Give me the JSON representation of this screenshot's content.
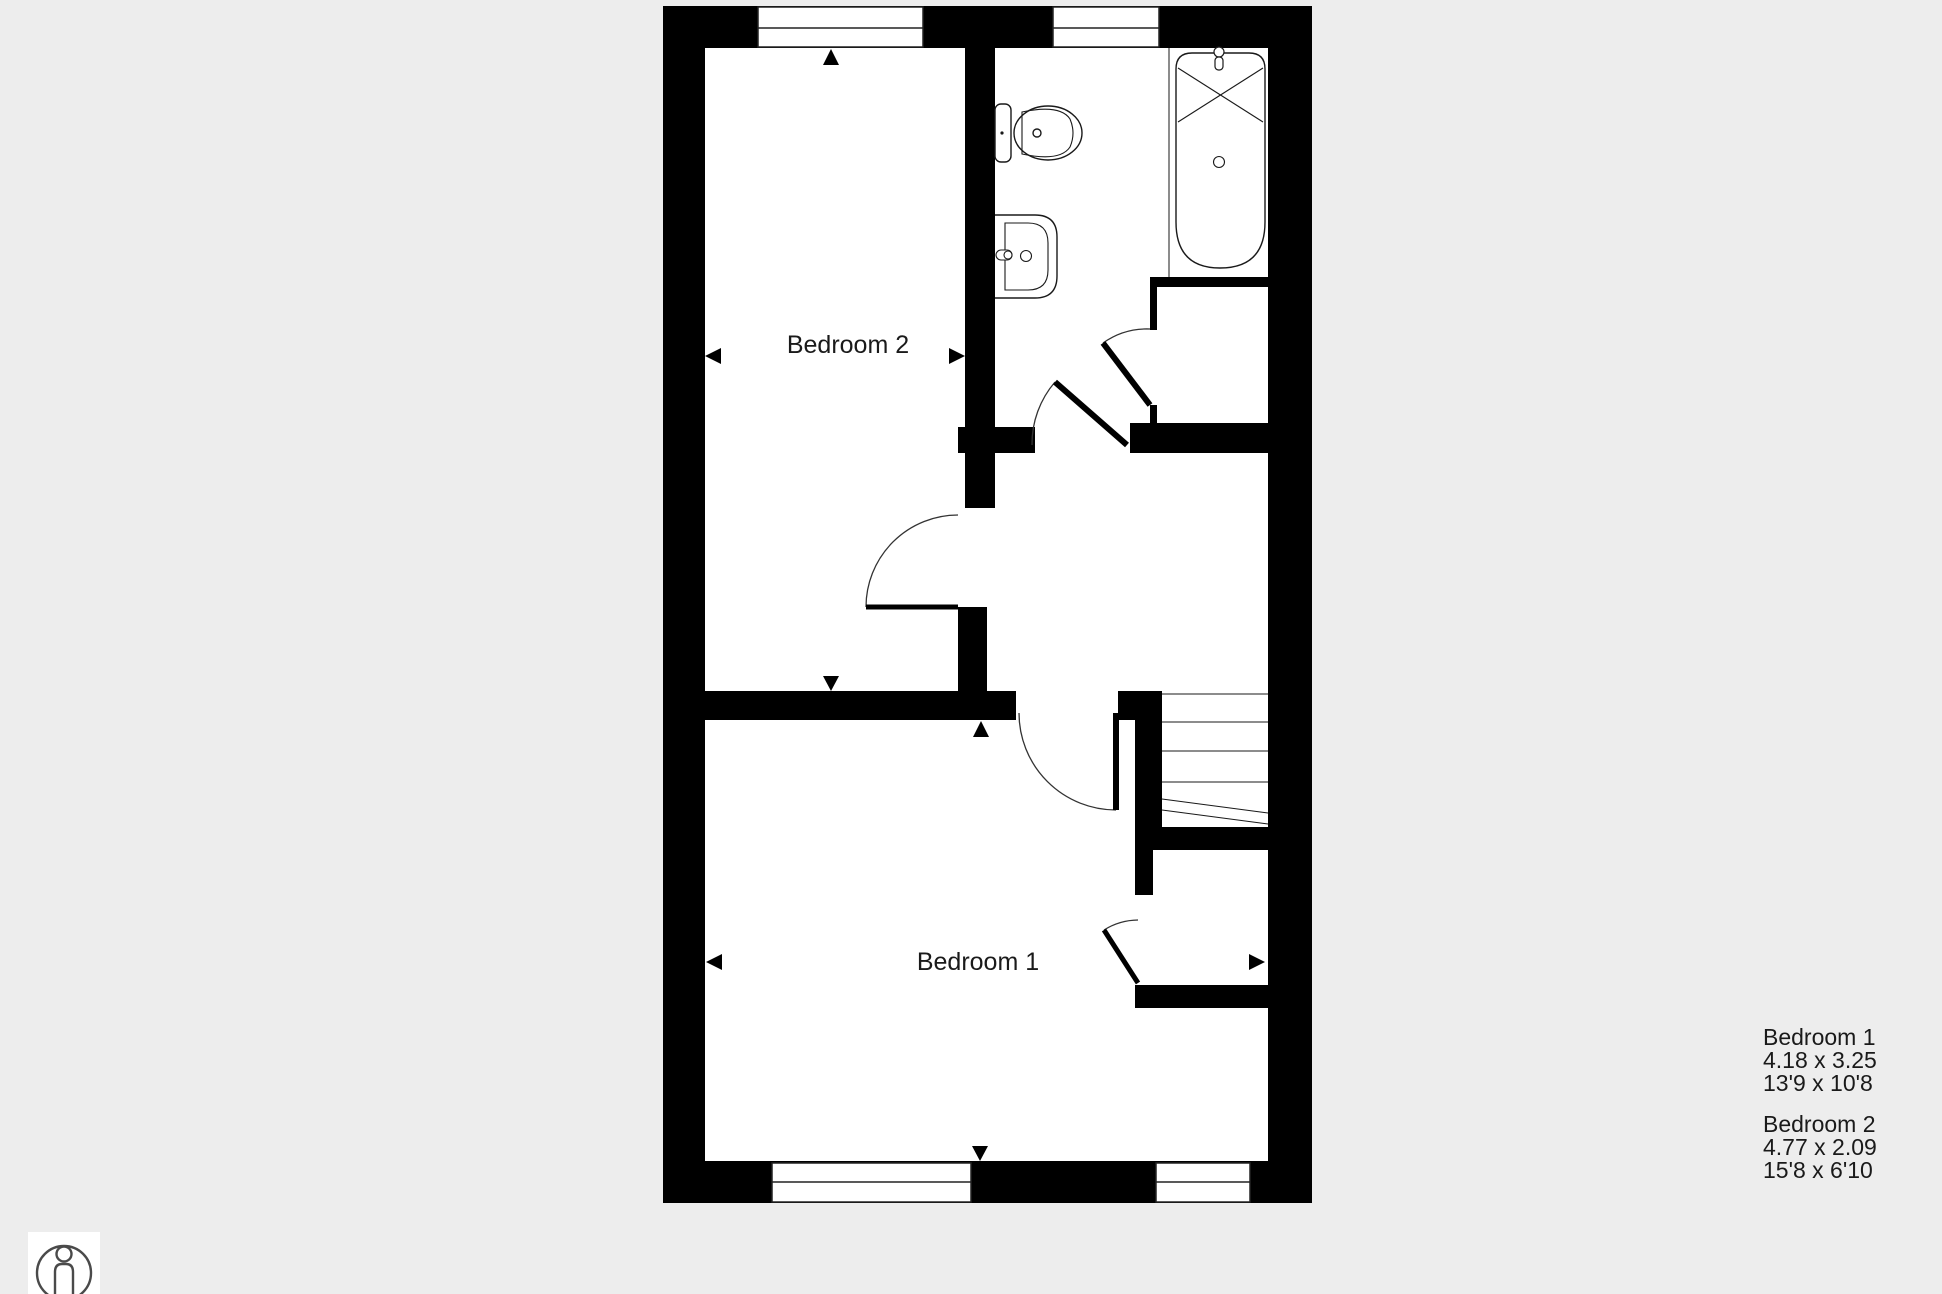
{
  "title": "Floor plan",
  "colors": {
    "background": "#ededed",
    "wall": "#000000",
    "floor": "#ffffff",
    "line": "#2a2a2a",
    "text": "#1a1a1a",
    "logo_stroke": "#4a4a4a"
  },
  "rooms": {
    "bedroom1": {
      "label": "Bedroom 1"
    },
    "bedroom2": {
      "label": "Bedroom 2"
    }
  },
  "fixtures": [
    "toilet",
    "sink",
    "bathtub",
    "stairs"
  ],
  "legend": {
    "entries": [
      {
        "name": "Bedroom 1",
        "metric": "4.18 x 3.25",
        "imperial": "13'9 x 10'8"
      },
      {
        "name": "Bedroom 2",
        "metric": "4.77 x 2.09",
        "imperial": "15'8 x 6'10"
      }
    ]
  },
  "logo": {
    "name": "person-in-circle"
  }
}
